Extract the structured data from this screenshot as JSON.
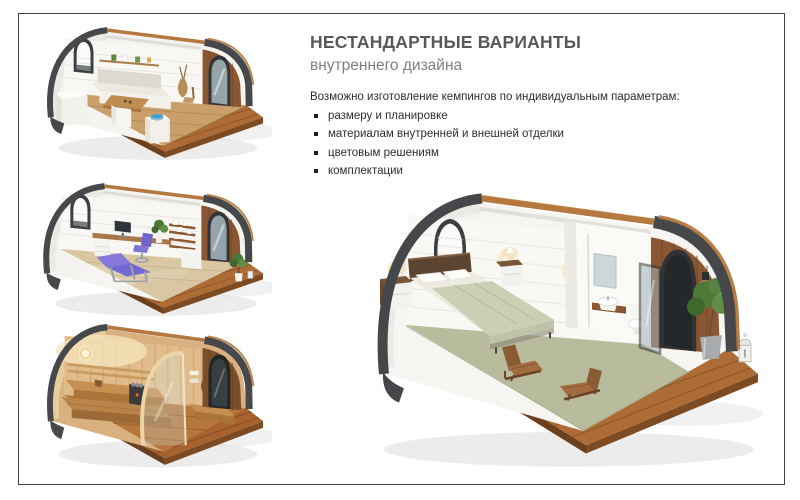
{
  "slide": {
    "title": "НЕСТАНДАРТНЫЕ ВАРИАНТЫ",
    "subtitle": "внутреннего дизайна",
    "intro": "Возможно изготовление кемпингов по индивидуальным параметрам:",
    "bullets": [
      "размеру и планировке",
      "материалам внутренней и внешней отделки",
      "цветовым решениям",
      "комплектации"
    ]
  },
  "images": {
    "top_left": "kitchen-dining-pod-render",
    "middle_left": "office-massage-pod-render",
    "bottom_left": "sauna-pod-render",
    "main": "bedroom-pod-render"
  },
  "colors": {
    "title": "#58585a",
    "subtitle": "#808083",
    "body_text": "#2d2d2d",
    "border": "#45453a",
    "shell_dark": "#45474a",
    "wood_deck": "#ad6c36",
    "wood_rim": "#b5793f",
    "wall_white": "#f6f5f1",
    "carpet_green": "#b8bc9d",
    "accent_purple": "#7f74d6",
    "sauna_wood": "#d9b180",
    "bowl_blue": "#3f9fd0"
  }
}
